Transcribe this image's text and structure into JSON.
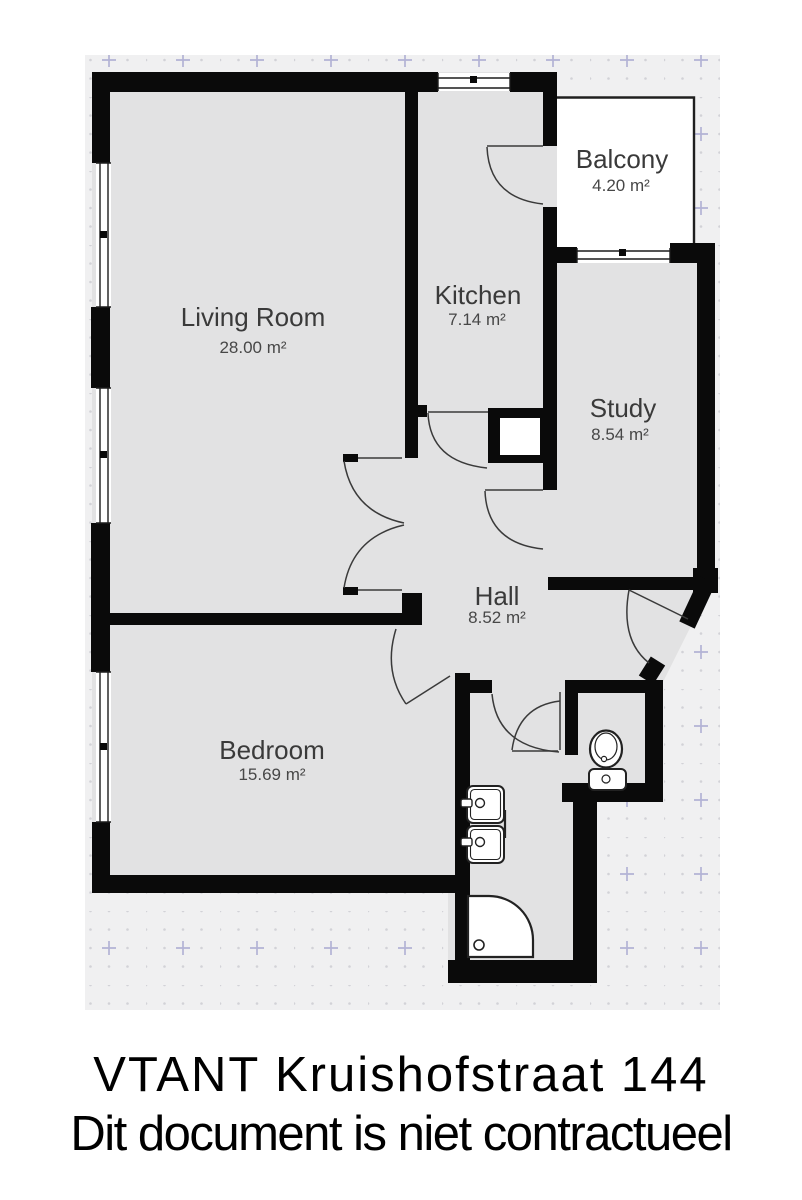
{
  "plan": {
    "rooms": [
      {
        "id": "living-room",
        "name": "Living Room",
        "area": "28.00 m²"
      },
      {
        "id": "kitchen",
        "name": "Kitchen",
        "area": "7.14 m²"
      },
      {
        "id": "balcony",
        "name": "Balcony",
        "area": "4.20 m²"
      },
      {
        "id": "study",
        "name": "Study",
        "area": "8.54 m²"
      },
      {
        "id": "hall",
        "name": "Hall",
        "area": "8.52 m²"
      },
      {
        "id": "bedroom",
        "name": "Bedroom",
        "area": "15.69 m²"
      }
    ],
    "fixtures": [
      {
        "name": "toilet"
      },
      {
        "name": "double-sink"
      },
      {
        "name": "corner-shower"
      }
    ],
    "colors": {
      "wall": "#0a0a0a",
      "room_fill": "#e2e2e3",
      "grid_bg": "#f0f0f1",
      "grid_dot": "#d2d2d7",
      "grid_cross": "#b3b3d5",
      "balcony_fill": "#ffffff",
      "label": "#3a3a3a"
    }
  },
  "footer": {
    "line1": "VTANT Kruishofstraat 144",
    "line2": "Dit document is niet contractueel"
  }
}
